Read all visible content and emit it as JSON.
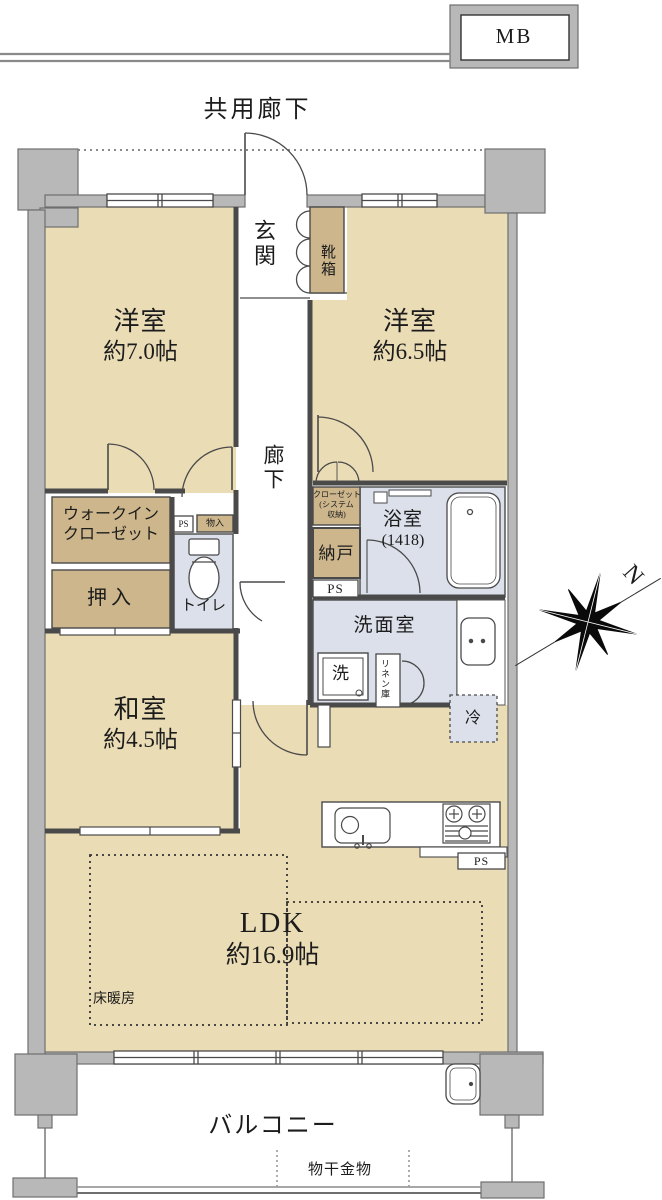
{
  "labels": {
    "mb": "MB",
    "common_corridor": "共用廊下",
    "entrance": "玄関",
    "shoe_box": "靴箱",
    "room_west1": "洋室",
    "room_west1_size": "約7.0帖",
    "room_west2": "洋室",
    "room_west2_size": "約6.5帖",
    "corridor": "廊下",
    "wic_line1": "ウォークイン",
    "wic_line2": "クローゼット",
    "oshiire": "押入",
    "toilet": "トイレ",
    "ps": "PS",
    "monoire": "物入",
    "closet_line1": "クローゼット",
    "closet_line2": "(システム",
    "closet_line3": "収納)",
    "nando": "納戸",
    "bath": "浴室",
    "bath_size": "(1418)",
    "washroom": "洗面室",
    "washer": "洗",
    "linen": "リネン庫",
    "fridge": "冷",
    "japanese_room": "和室",
    "japanese_room_size": "約4.5帖",
    "ldk": "LDK",
    "ldk_size": "約16.9帖",
    "floor_heating": "床暖房",
    "balcony": "バルコニー",
    "laundry_hardware": "物干金物",
    "north": "N"
  },
  "colors": {
    "room_fill": "#eadcb5",
    "storage_fill": "#cdb68c",
    "wet_area_fill": "#dbe0ea",
    "wall_fill": "#b8b8b8",
    "wall_border": "#6f6f6f",
    "line": "#4a4a4a"
  }
}
